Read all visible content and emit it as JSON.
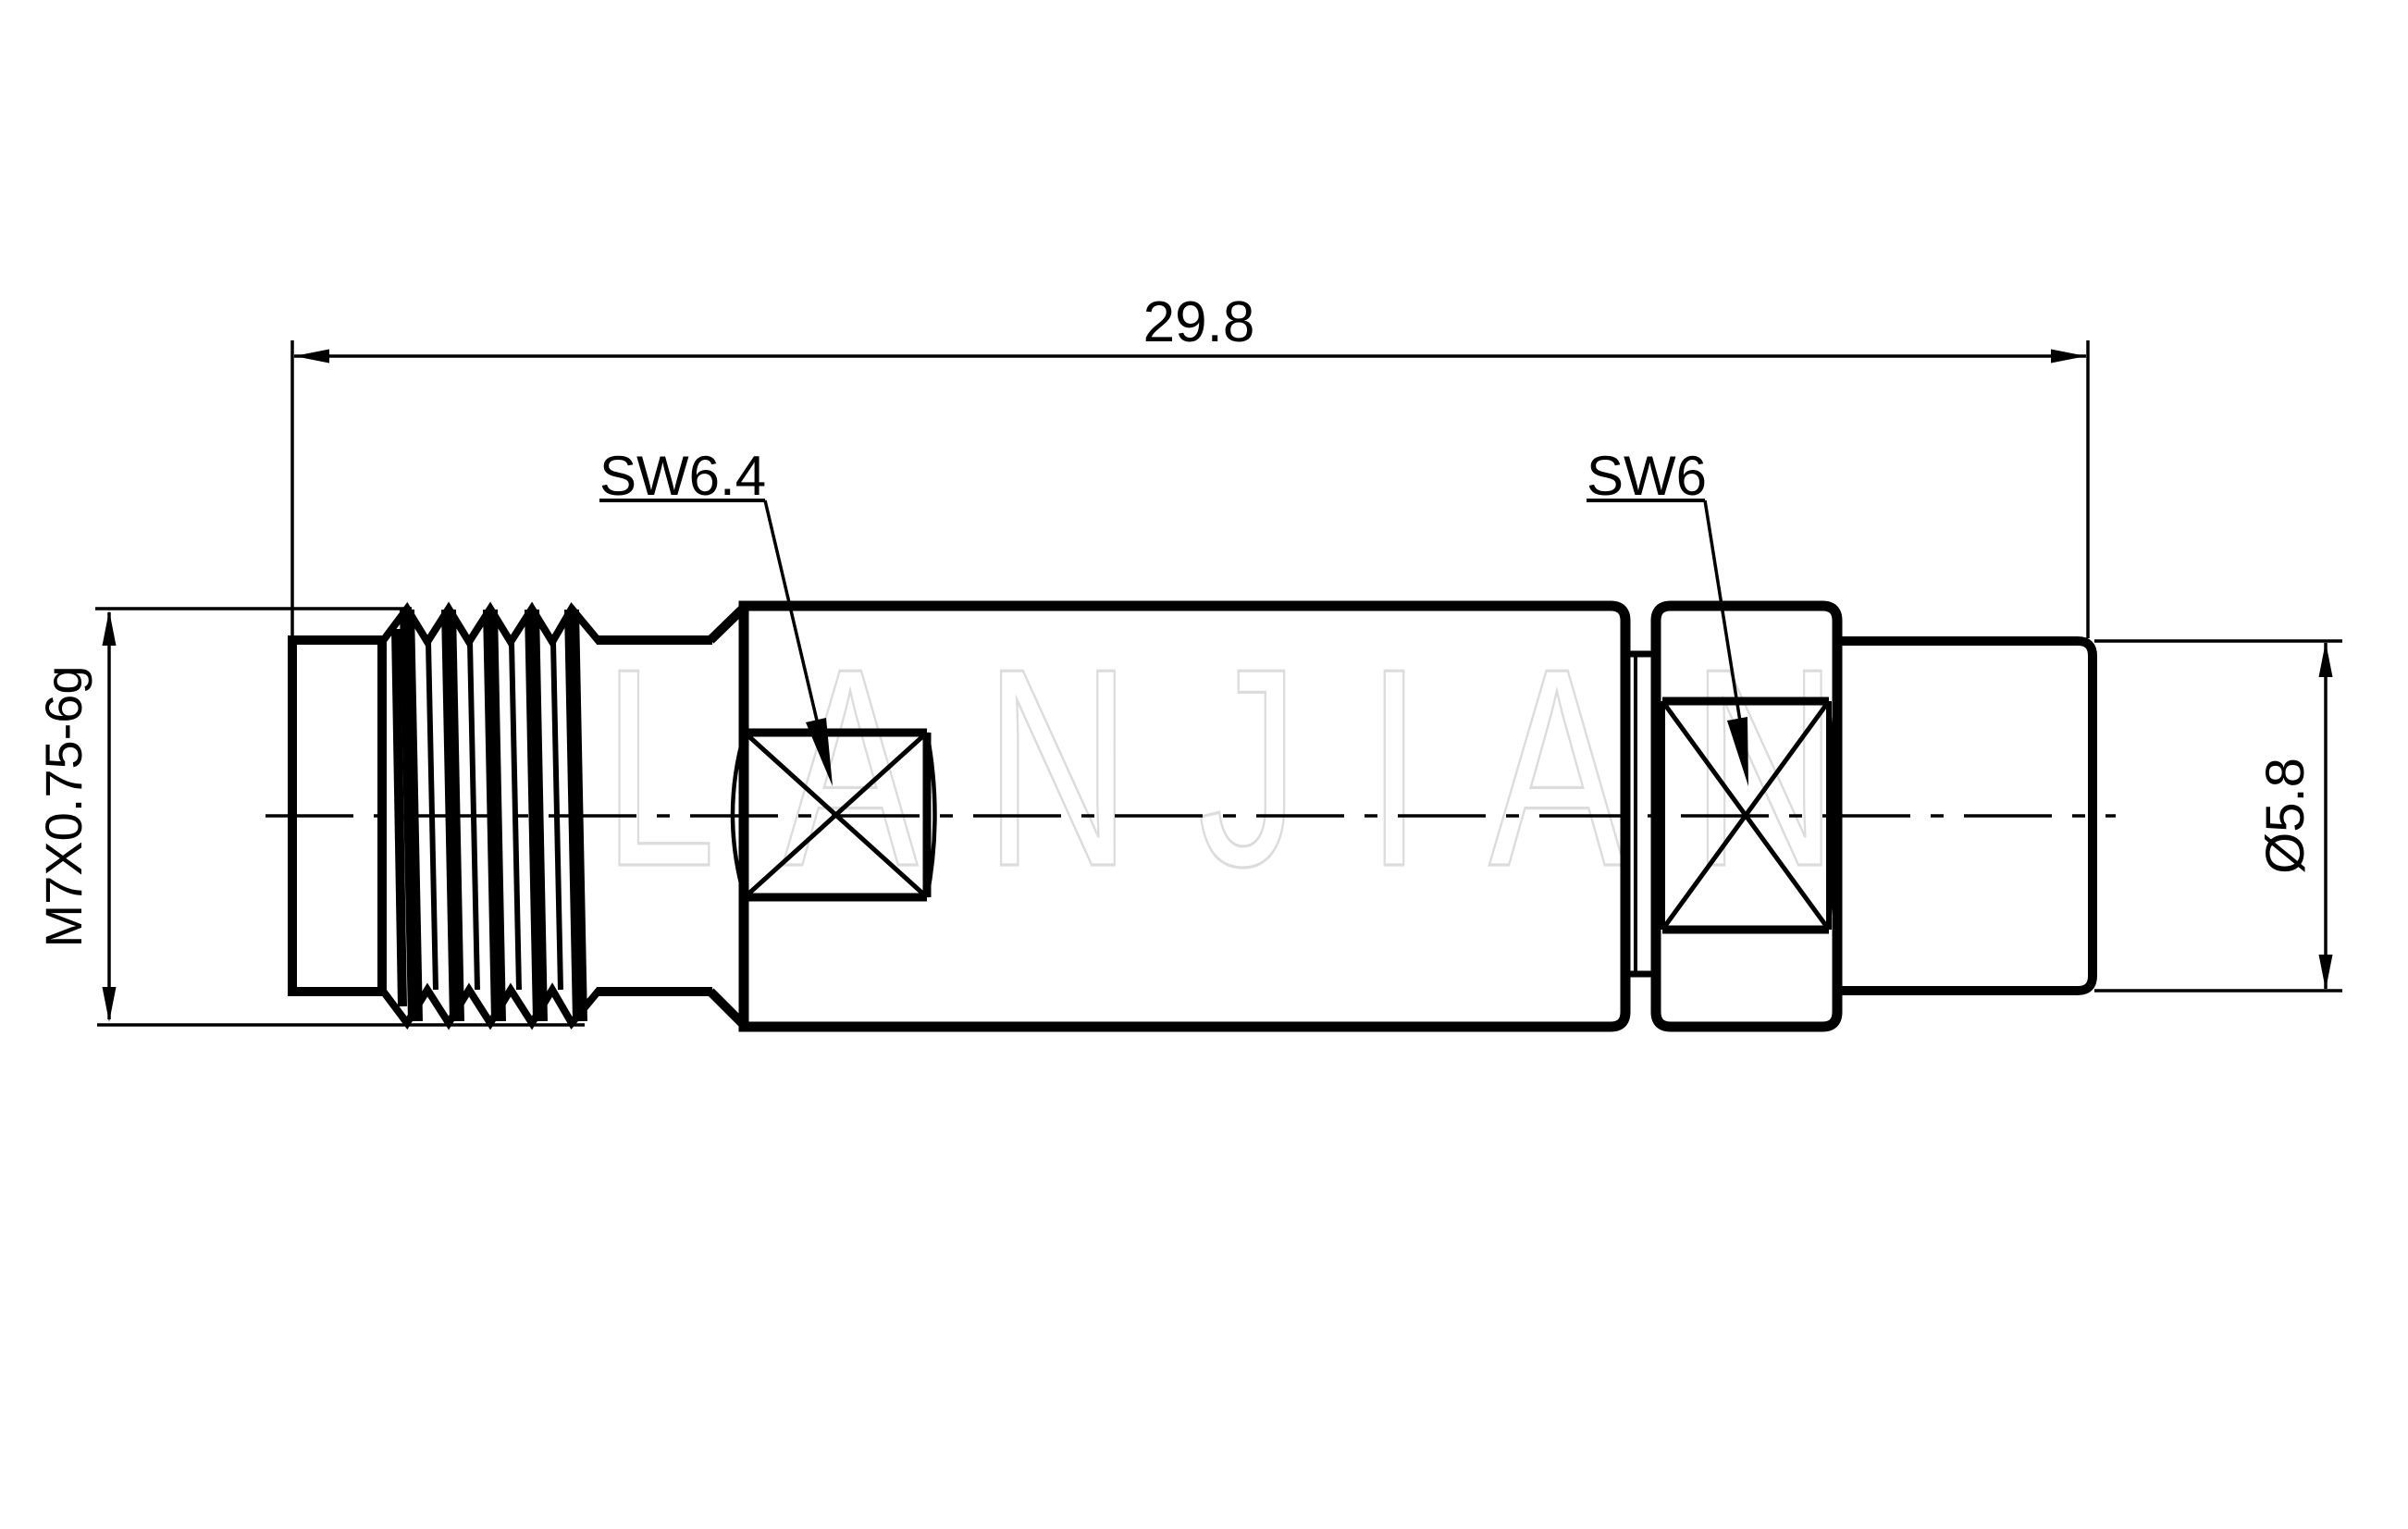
{
  "drawing": {
    "type": "technical-drawing",
    "part": "coaxial adapter side view",
    "dimensions": {
      "overall_length": "29.8",
      "thread_spec": "M7X0.75-6g",
      "wrench_flat_left": "SW6.4",
      "wrench_flat_right": "SW6",
      "right_diameter": "Ø5.8"
    },
    "watermark": "LANJIAN",
    "colors": {
      "line": "#000000",
      "background": "#ffffff",
      "watermark_stroke": "#dcdcdc"
    }
  }
}
